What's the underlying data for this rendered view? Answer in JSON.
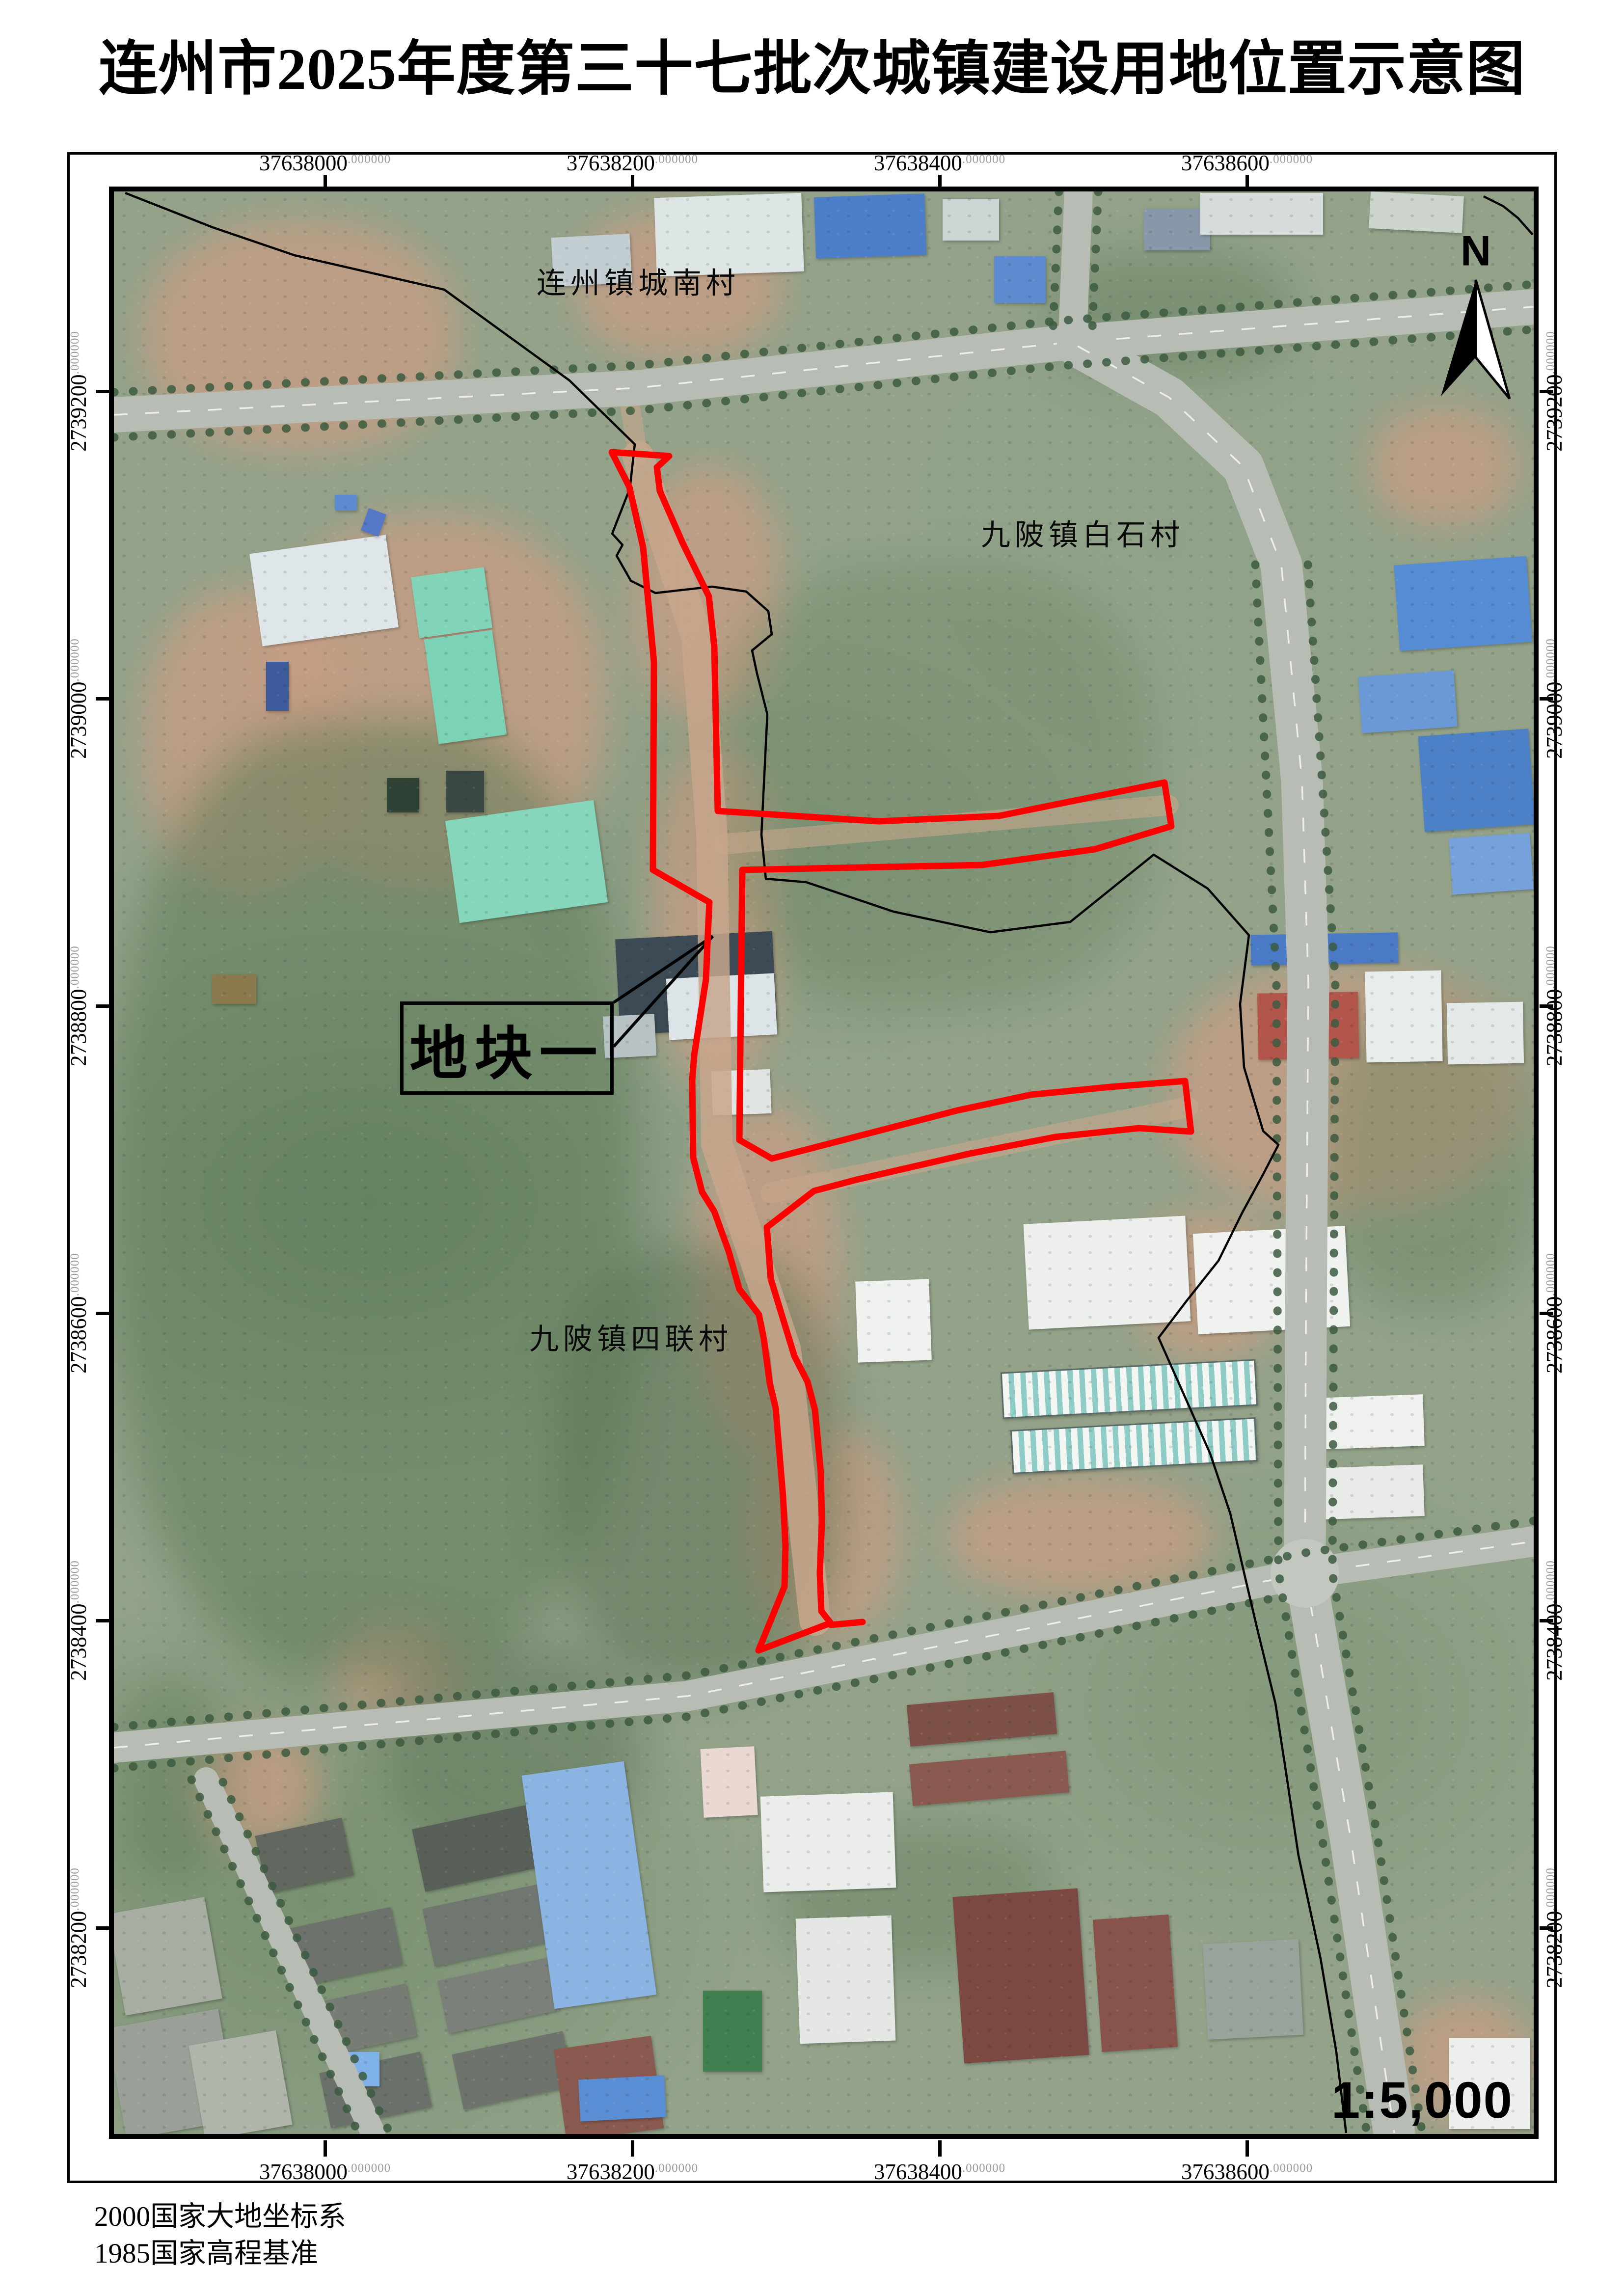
{
  "title": "连州市2025年度第三十七批次城镇建设用地位置示意图",
  "notes": {
    "line1": "2000国家大地坐标系",
    "line2": "1985国家高程基准"
  },
  "grid": {
    "decimal_suffix": ".000000",
    "x_labels": [
      "37638000",
      "37638200",
      "37638400",
      "37638600"
    ],
    "y_labels": [
      "2739200",
      "2739000",
      "2738800",
      "2738600",
      "2738400",
      "2738200"
    ]
  },
  "map": {
    "north_label": "N",
    "scale_text": "1:5,000",
    "plot_label": "地块一",
    "villages": [
      {
        "name": "连州镇城南村"
      },
      {
        "name": "九陂镇白石村"
      },
      {
        "name": "九陂镇四联村"
      }
    ],
    "boundary_color": "#ff0000",
    "admin_line_color": "#000000",
    "boundary_points": [
      [
        1014,
        531
      ],
      [
        1131,
        539
      ],
      [
        1106,
        562
      ],
      [
        1112,
        610
      ],
      [
        1158,
        715
      ],
      [
        1212,
        825
      ],
      [
        1223,
        928
      ],
      [
        1230,
        1262
      ],
      [
        1558,
        1283
      ],
      [
        1803,
        1272
      ],
      [
        2140,
        1204
      ],
      [
        2154,
        1293
      ],
      [
        1998,
        1340
      ],
      [
        1768,
        1372
      ],
      [
        1280,
        1382
      ],
      [
        1274,
        1932
      ],
      [
        1340,
        1970
      ],
      [
        1718,
        1872
      ],
      [
        1868,
        1840
      ],
      [
        2030,
        1824
      ],
      [
        2182,
        1812
      ],
      [
        2194,
        1915
      ],
      [
        2088,
        1908
      ],
      [
        1918,
        1926
      ],
      [
        1743,
        1960
      ],
      [
        1513,
        2013
      ],
      [
        1426,
        2036
      ],
      [
        1330,
        2110
      ],
      [
        1338,
        2215
      ],
      [
        1386,
        2372
      ],
      [
        1413,
        2425
      ],
      [
        1428,
        2482
      ],
      [
        1440,
        2610
      ],
      [
        1442,
        2710
      ],
      [
        1438,
        2815
      ],
      [
        1441,
        2892
      ],
      [
        1460,
        2916
      ],
      [
        1313,
        2972
      ],
      [
        1366,
        2842
      ],
      [
        1368,
        2760
      ],
      [
        1363,
        2658
      ],
      [
        1348,
        2478
      ],
      [
        1336,
        2428
      ],
      [
        1324,
        2338
      ],
      [
        1314,
        2288
      ],
      [
        1274,
        2236
      ],
      [
        1252,
        2158
      ],
      [
        1223,
        2078
      ],
      [
        1198,
        2038
      ],
      [
        1180,
        1968
      ],
      [
        1178,
        1810
      ],
      [
        1182,
        1760
      ],
      [
        1206,
        1605
      ],
      [
        1210,
        1510
      ],
      [
        1213,
        1448
      ],
      [
        1098,
        1382
      ],
      [
        1100,
        958
      ],
      [
        1078,
        725
      ],
      [
        1050,
        602
      ]
    ],
    "boundary_stub": [
      [
        1460,
        2920
      ],
      [
        1525,
        2914
      ]
    ],
    "admin_line_points": [
      [
        23,
        3
      ],
      [
        201,
        73
      ],
      [
        368,
        130
      ],
      [
        673,
        200
      ],
      [
        928,
        385
      ],
      [
        1061,
        515
      ],
      [
        1051,
        605
      ],
      [
        1015,
        697
      ],
      [
        1036,
        720
      ],
      [
        1024,
        742
      ],
      [
        1053,
        793
      ],
      [
        1103,
        818
      ],
      [
        1218,
        805
      ],
      [
        1288,
        815
      ],
      [
        1333,
        855
      ],
      [
        1340,
        902
      ],
      [
        1300,
        935
      ],
      [
        1310,
        982
      ],
      [
        1331,
        1065
      ],
      [
        1319,
        1310
      ],
      [
        1328,
        1400
      ],
      [
        1410,
        1407
      ],
      [
        1588,
        1467
      ],
      [
        1785,
        1509
      ],
      [
        1948,
        1488
      ],
      [
        2118,
        1351
      ],
      [
        2228,
        1420
      ],
      [
        2312,
        1515
      ],
      [
        2294,
        1655
      ],
      [
        2302,
        1784
      ],
      [
        2341,
        1914
      ],
      [
        2372,
        1942
      ],
      [
        2341,
        2002
      ],
      [
        2299,
        2079
      ],
      [
        2250,
        2178
      ],
      [
        2185,
        2260
      ],
      [
        2128,
        2335
      ],
      [
        2233,
        2571
      ],
      [
        2274,
        2693
      ],
      [
        2304,
        2822
      ],
      [
        2328,
        2924
      ],
      [
        2366,
        3080
      ],
      [
        2386,
        3210
      ],
      [
        2413,
        3390
      ],
      [
        2458,
        3600
      ],
      [
        2490,
        3790
      ],
      [
        2510,
        3955
      ]
    ],
    "admin_line2_points": [
      [
        2790,
        10
      ],
      [
        2830,
        30
      ],
      [
        2860,
        54
      ],
      [
        2890,
        88
      ]
    ]
  }
}
